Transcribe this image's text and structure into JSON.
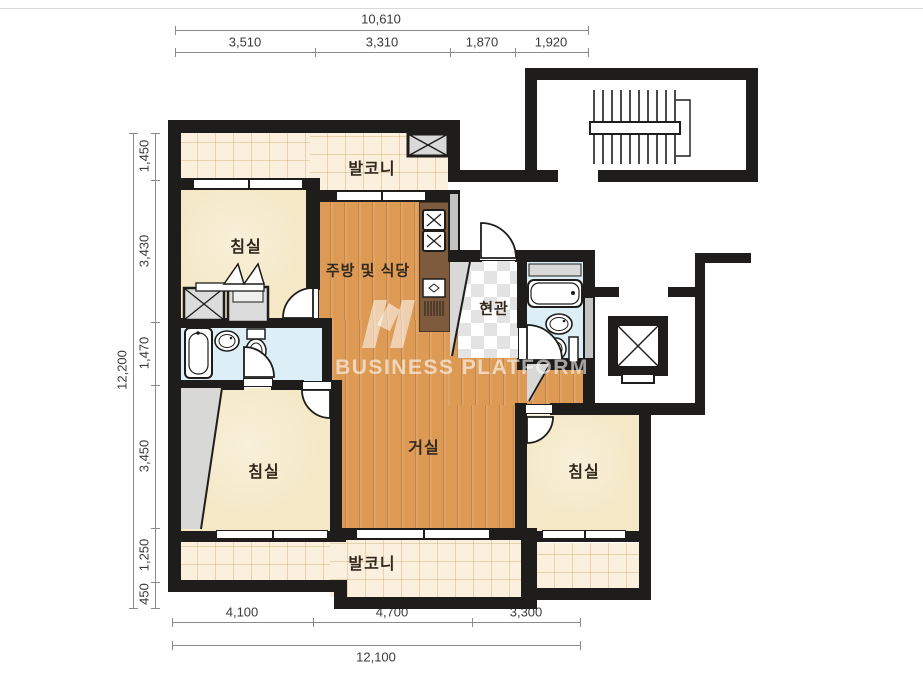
{
  "dimensions": {
    "top": {
      "total": "10,610",
      "segments": [
        "3,510",
        "3,310",
        "1,870",
        "1,920"
      ]
    },
    "left": {
      "total": "12,200",
      "segments": [
        "1,450",
        "3,430",
        "1,470",
        "3,450",
        "1,250",
        "450"
      ]
    },
    "bottom": {
      "total": "12,100",
      "segments": [
        "4,100",
        "4,700",
        "3,300"
      ]
    }
  },
  "rooms": {
    "balcony_top": "발코니",
    "bedroom_top_left": "침실",
    "kitchen_dining": "주방 및 식당",
    "entrance": "현관",
    "living_room": "거실",
    "bedroom_bottom_left": "침실",
    "bedroom_right": "침실",
    "balcony_bottom": "발코니"
  },
  "watermark": {
    "text": "BUSINESS PLATFORM"
  },
  "colors": {
    "wall": "#1e1d1b",
    "wood_floor": "#dc9a55",
    "tile_floor": "#faf0dd",
    "bedroom_floor": "#f4e8c6",
    "bath_floor": "#dceef6",
    "counter": "#7d5b3c"
  }
}
